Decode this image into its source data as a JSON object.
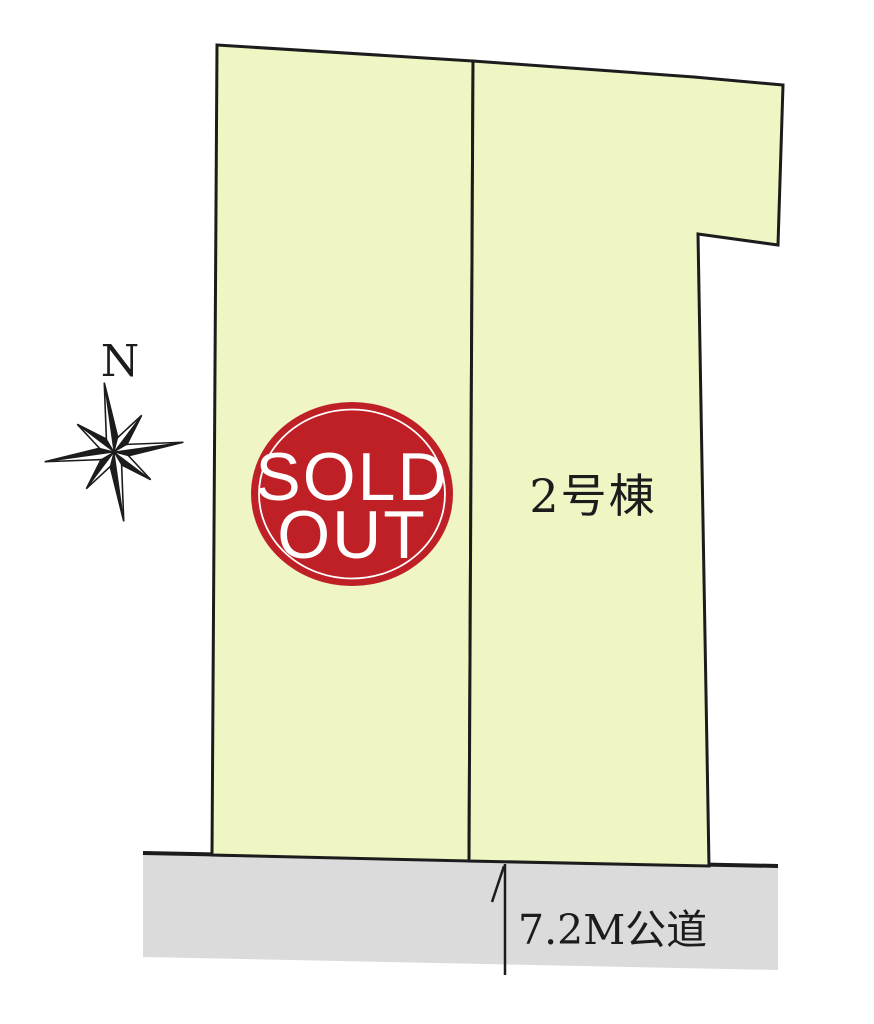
{
  "colors": {
    "lot_fill": "#EFF5C3",
    "road_fill": "#DBDBDB",
    "outline": "#1C1C1C",
    "sold_badge_red": "#BE2026",
    "badge_text": "#FFFFFF",
    "label_text": "#1C1C1C"
  },
  "compass": {
    "label": "N"
  },
  "lots": {
    "sold": {
      "points": "217,45 473,61 469,861 212,855",
      "badge": {
        "line1": "SOLD",
        "line2": "OUT"
      }
    },
    "unit2": {
      "points": "473,61 694,77 783,85 778,245 698,234 709,866 469,861",
      "label": "2号棟"
    }
  },
  "road": {
    "points": "143,852 778,866 778,970 143,957",
    "top_edge_points": "143,853 778,866",
    "label": "7.2M公道"
  }
}
